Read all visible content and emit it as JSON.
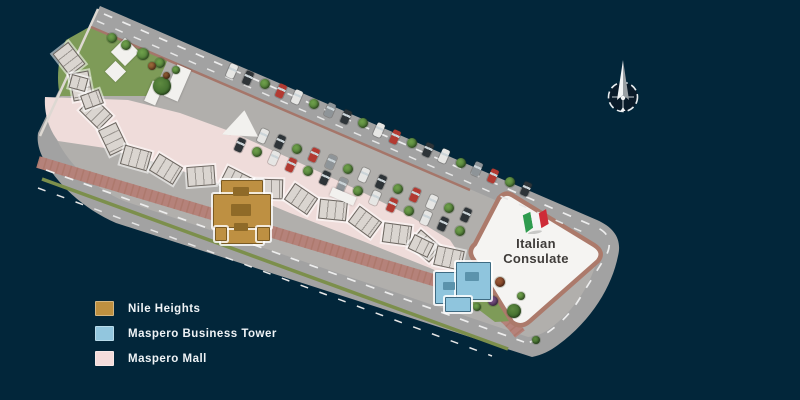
{
  "scene": {
    "background": "#02263A"
  },
  "legend": {
    "items": [
      {
        "id": "nile-heights",
        "label": "Nile Heights",
        "color": "#BE9040"
      },
      {
        "id": "maspero-business-tower",
        "label": "Maspero Business Tower",
        "color": "#92C6DE"
      },
      {
        "id": "maspero-mall",
        "label": "Maspero Mall",
        "color": "#F4DCDB"
      }
    ]
  },
  "consulate": {
    "line1": "Italian",
    "line2": "Consulate",
    "flag": {
      "green": "#2E9B4E",
      "white": "#F4F4F4",
      "red": "#CE2B37"
    }
  }
}
